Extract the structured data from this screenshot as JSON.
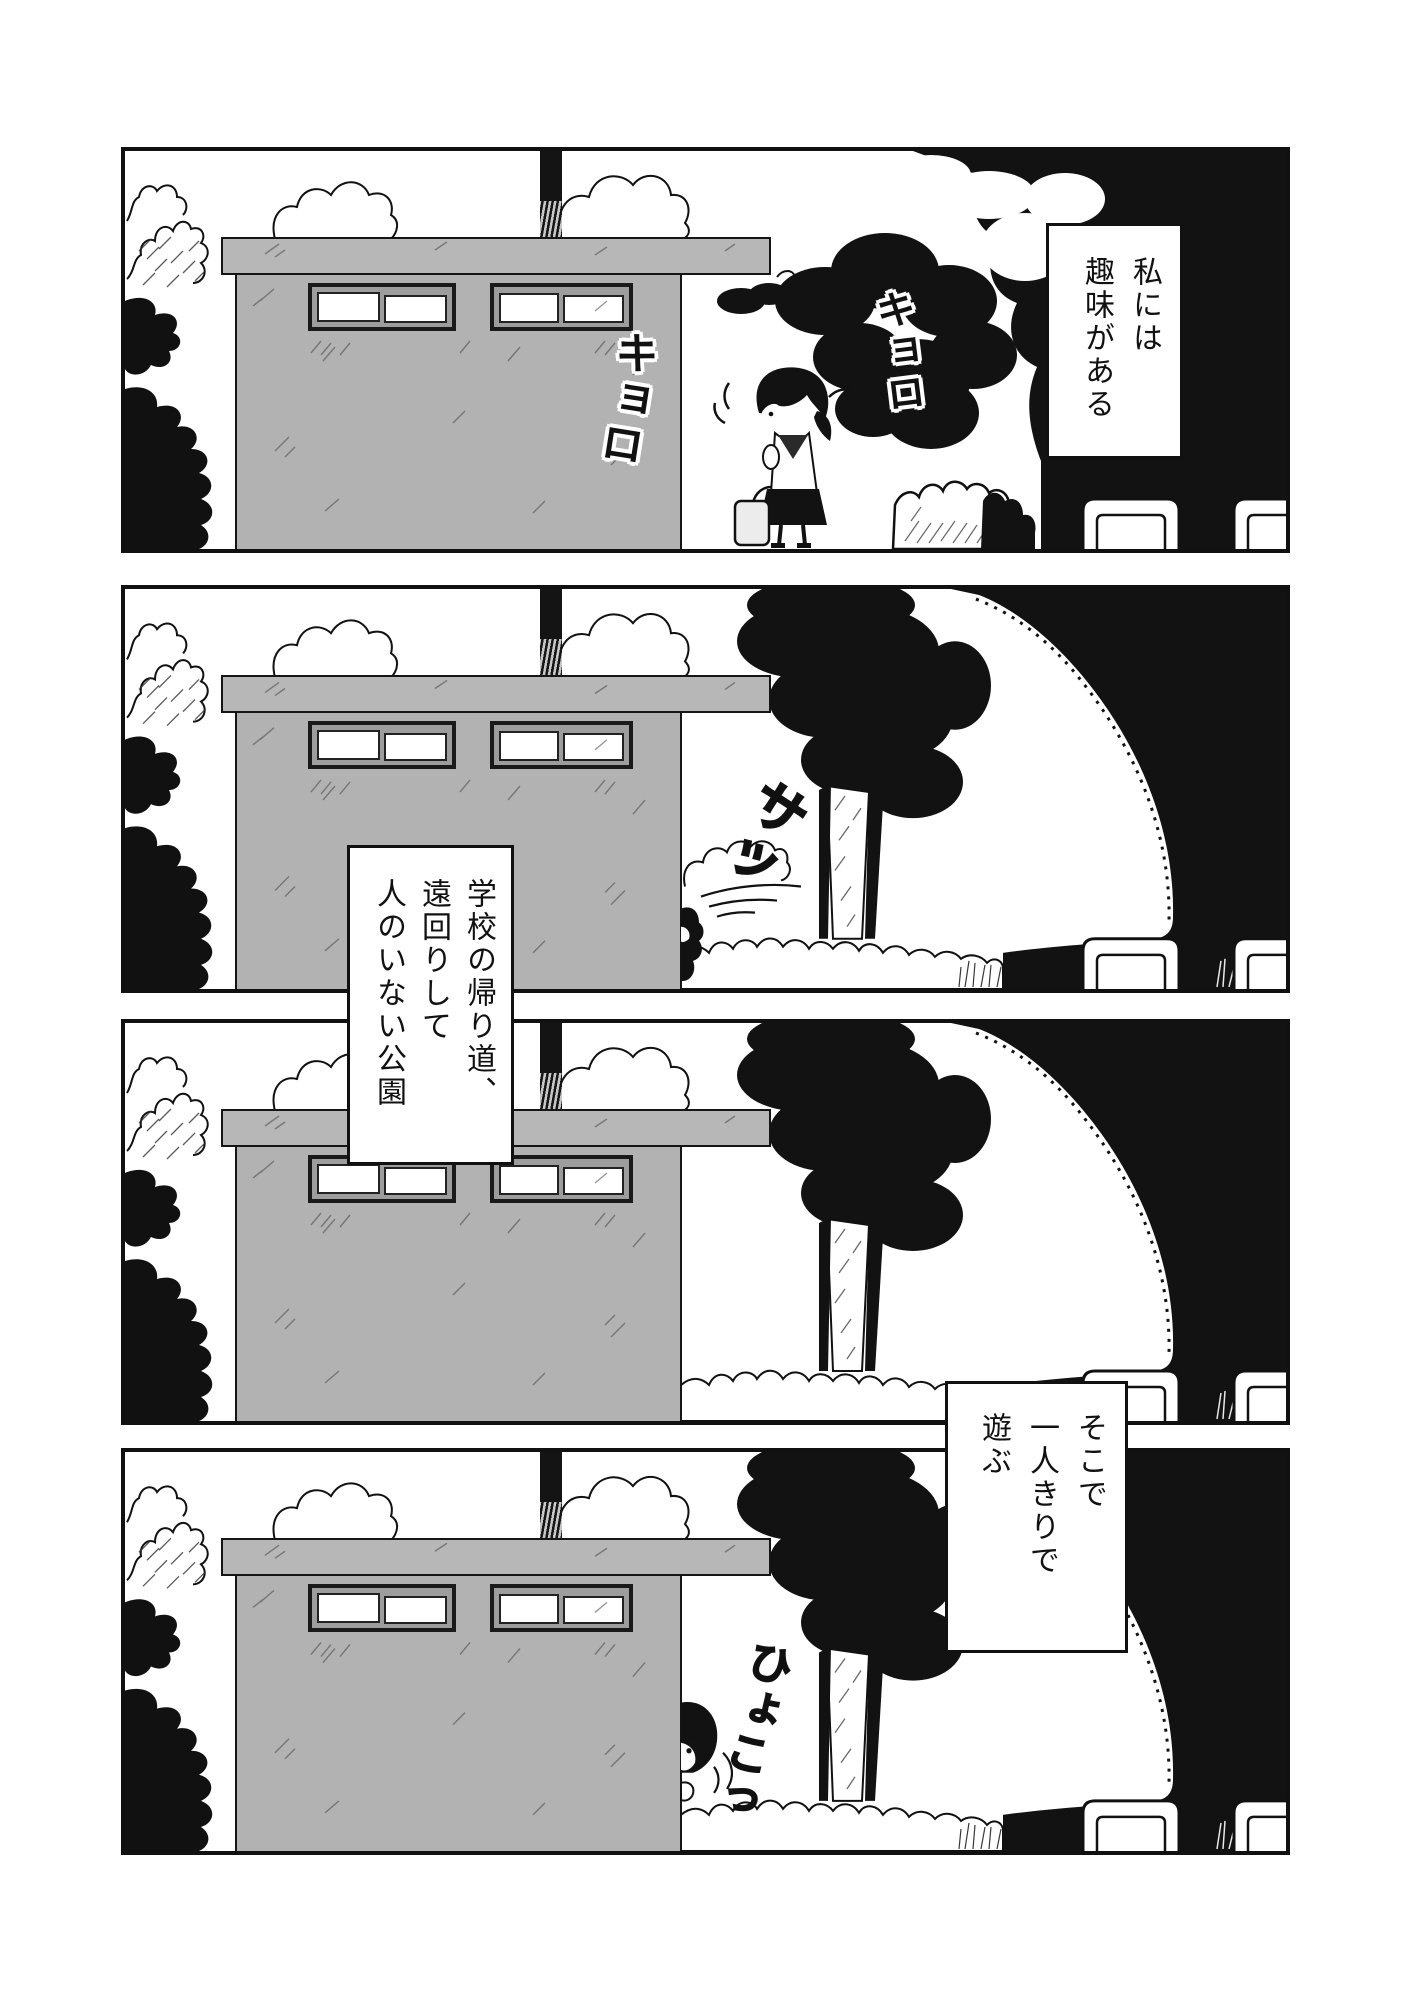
{
  "page": {
    "type": "manga-page",
    "background": "#ffffff",
    "panel_count": 4
  },
  "colors": {
    "ink": "#141414",
    "panel_border": "#111111",
    "wall_gray": "#b2b2b2",
    "roof_gray": "#b7b7b7",
    "window_frame": "#1a1a1a",
    "window_sash": "#9d9d9d"
  },
  "captions": {
    "c1": {
      "text": "私には\n趣味がある"
    },
    "c2": {
      "text": "学校の帰り道、\n遠回りして\n人のいない公園"
    },
    "c3": {
      "text": "そこで\n一人きりで\n遊ぶ"
    }
  },
  "sfx": {
    "kyoro1": {
      "text": "キョロ",
      "style": "white-outlined"
    },
    "kyoro2": {
      "text": "キョロ",
      "style": "white-outlined"
    },
    "satto": {
      "text": "サッ",
      "style": "plain"
    },
    "hyoko": {
      "text": "ひょこっ",
      "style": "plain"
    }
  }
}
